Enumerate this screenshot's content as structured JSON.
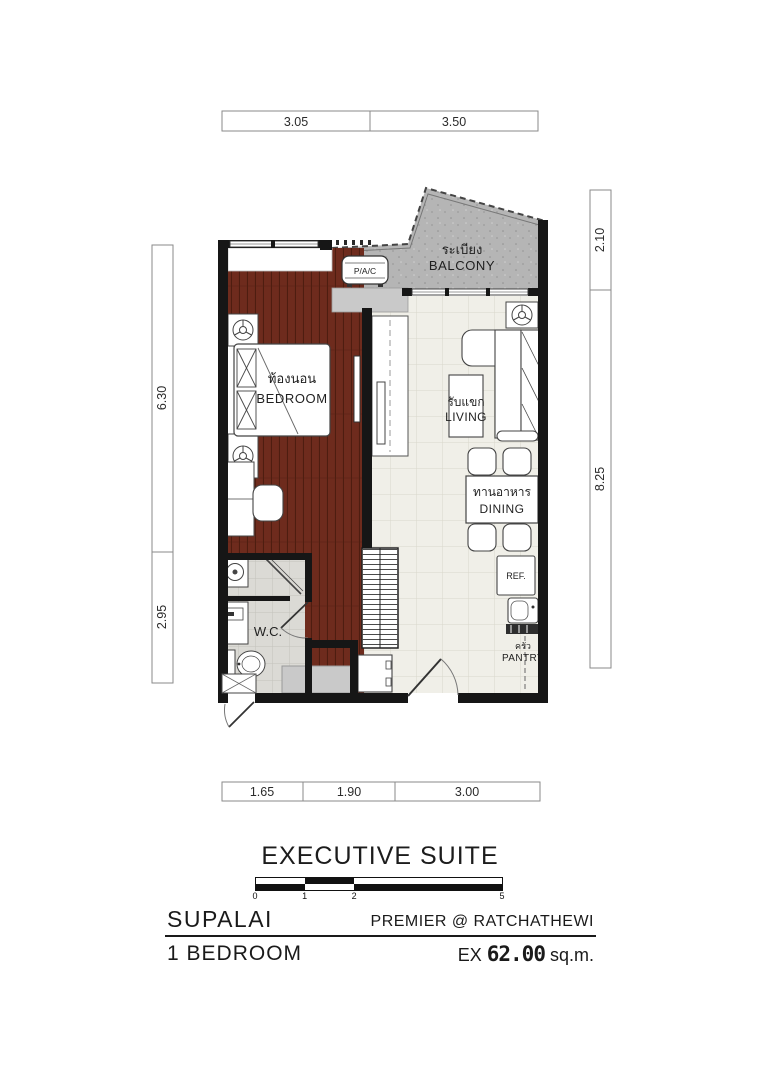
{
  "colors": {
    "wood": "#6e2b1d",
    "tile": "#f0efe8",
    "balcony": "#b5b5b5",
    "ledge": "#c9c9c9",
    "wcFloor": "#dbdad5",
    "wall": "#161616"
  },
  "dimensions": {
    "top": [
      "3.05",
      "3.50"
    ],
    "bottom": [
      "1.65",
      "1.90",
      "3.00"
    ],
    "left": [
      "6.30",
      "2.95"
    ],
    "right": [
      "2.10",
      "8.25"
    ]
  },
  "rooms": {
    "bedroom": {
      "thai": "ท้องนอน",
      "en": "BEDROOM"
    },
    "living": {
      "thai": "รับแขก",
      "en": "LIVING"
    },
    "dining": {
      "thai": "ทานอาหาร",
      "en": "DINING"
    },
    "balcony": {
      "thai": "ระเบียง",
      "en": "BALCONY"
    },
    "wc": {
      "en": "W.C."
    },
    "pantry": {
      "thai": "ครัว",
      "en": "PANTRY"
    },
    "fridge": {
      "en": "REF."
    },
    "ac_unit": {
      "en": "P/A/C"
    }
  },
  "scalebar": {
    "ticks": [
      "0",
      "1",
      "2",
      "5"
    ]
  },
  "title": "EXECUTIVE SUITE",
  "footer": {
    "brand": "SUPALAI",
    "project": "PREMIER @ RATCHATHEWI",
    "unit_type": "1 BEDROOM",
    "area_prefix": "EX",
    "area_value": "62.00",
    "area_unit": "sq.m."
  }
}
